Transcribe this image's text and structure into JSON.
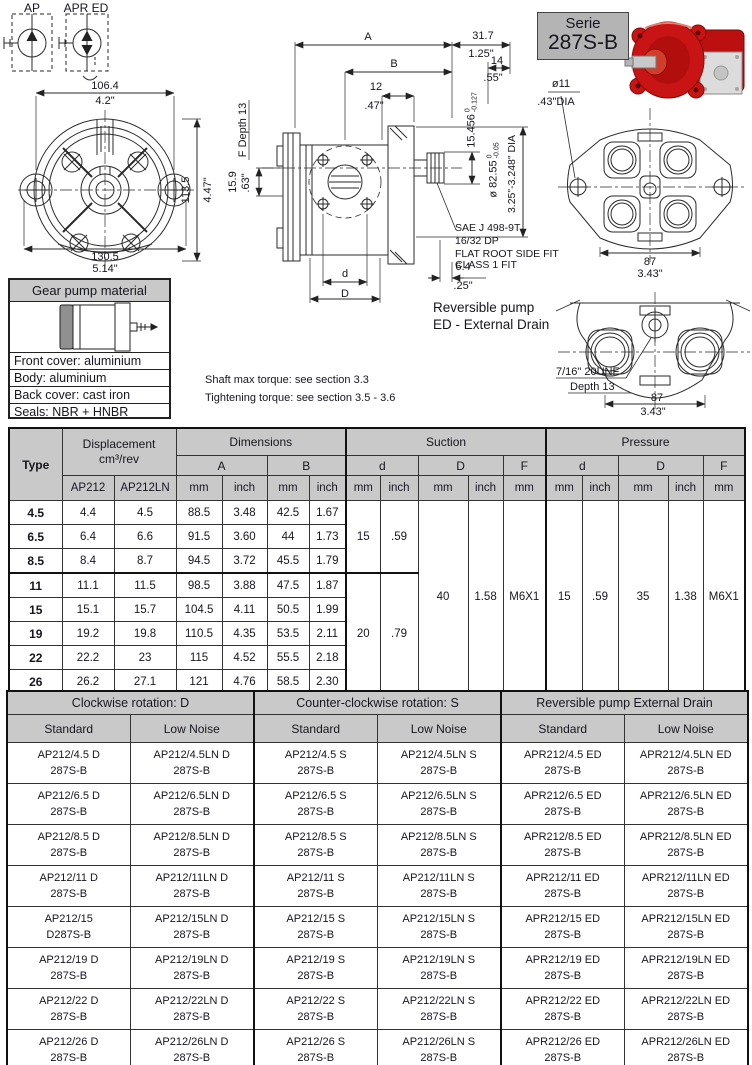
{
  "symbols": {
    "ap": "AP",
    "apr_ed": "APR ED"
  },
  "serie_box": {
    "line1": "Serie",
    "line2": "287S-B"
  },
  "front_view": {
    "width_mm": "106.4",
    "width_in": "4.2\"",
    "height_mm": "113.5",
    "height_in": "4.47\"",
    "total_width_mm": "130.5",
    "total_width_in": "5.14\""
  },
  "side_view": {
    "dim_a": "A",
    "dim_b": "B",
    "d31_7": "31.7",
    "d1_25": "1.25\"",
    "d14": "14",
    "d0_55": ".55\"",
    "d12": "12",
    "d0_47": ".47\"",
    "f_depth": "F Depth 13",
    "d15_9": "15.9",
    "d0_63": ".63\"",
    "shaft_tol": {
      "value": "15.456",
      "top": "0",
      "bottom": "-0.127"
    },
    "pilot_tol": {
      "value": "ø 82.55",
      "top": "0",
      "bottom": "-0.05"
    },
    "pilot_dia_in": "3.25\"-3.248\" DIA",
    "spline_note": [
      "SAE J 498-9T",
      "16/32 DP",
      "FLAT ROOT SIDE FIT",
      "CLASS 1 FIT"
    ],
    "dim_d": "d",
    "dim_D": "D",
    "d6_4": "6.4",
    "d0_25": ".25\""
  },
  "rear_view": {
    "dia11": "ø11",
    "dia11_in": ".43\"DIA",
    "width_mm": "87",
    "width_in": "3.43\""
  },
  "reversible_view": {
    "label_l1": "Reversible pump",
    "label_l2": "ED - External Drain",
    "port": "7/16\" 20UNF",
    "port_depth": "Depth 13",
    "width_mm": "87",
    "width_in": "3.43\""
  },
  "material_box": {
    "title": "Gear pump material",
    "rows": [
      "Front cover: aluminium",
      "Body: aluminium",
      "Back cover: cast iron",
      "Seals: NBR + HNBR"
    ]
  },
  "notes": [
    "Shaft max torque: see section 3.3",
    "Tightening torque: see section 3.5 - 3.6"
  ],
  "dim_table": {
    "headers": {
      "type": "Type",
      "displacement_l1": "Displacement",
      "displacement_l2": "cm³/rev",
      "dimensions": "Dimensions",
      "suction": "Suction",
      "pressure": "Pressure",
      "col_a": "A",
      "col_b": "B",
      "col_d": "d",
      "col_dd": "D",
      "col_f": "F",
      "mm": "mm",
      "inch": "inch",
      "ap212": "AP212",
      "ap212ln": "AP212LN"
    },
    "rows": [
      {
        "type": "4.5",
        "ap212": "4.4",
        "ap212ln": "4.5",
        "a_mm": "88.5",
        "a_inch": "3.48",
        "b_mm": "42.5",
        "b_inch": "1.67"
      },
      {
        "type": "6.5",
        "ap212": "6.4",
        "ap212ln": "6.6",
        "a_mm": "91.5",
        "a_inch": "3.60",
        "b_mm": "44",
        "b_inch": "1.73"
      },
      {
        "type": "8.5",
        "ap212": "8.4",
        "ap212ln": "8.7",
        "a_mm": "94.5",
        "a_inch": "3.72",
        "b_mm": "45.5",
        "b_inch": "1.79"
      },
      {
        "type": "11",
        "ap212": "11.1",
        "ap212ln": "11.5",
        "a_mm": "98.5",
        "a_inch": "3.88",
        "b_mm": "47.5",
        "b_inch": "1.87"
      },
      {
        "type": "15",
        "ap212": "15.1",
        "ap212ln": "15.7",
        "a_mm": "104.5",
        "a_inch": "4.11",
        "b_mm": "50.5",
        "b_inch": "1.99"
      },
      {
        "type": "19",
        "ap212": "19.2",
        "ap212ln": "19.8",
        "a_mm": "110.5",
        "a_inch": "4.35",
        "b_mm": "53.5",
        "b_inch": "2.11"
      },
      {
        "type": "22",
        "ap212": "22.2",
        "ap212ln": "23",
        "a_mm": "115",
        "a_inch": "4.52",
        "b_mm": "55.5",
        "b_inch": "2.18"
      },
      {
        "type": "26",
        "ap212": "26.2",
        "ap212ln": "27.1",
        "a_mm": "121",
        "a_inch": "4.76",
        "b_mm": "58.5",
        "b_inch": "2.30"
      }
    ],
    "suction": {
      "d_groups": [
        {
          "span": 3,
          "mm": "15",
          "inch": ".59"
        },
        {
          "span": 5,
          "mm": "20",
          "inch": ".79"
        }
      ],
      "D_mm": "40",
      "D_inch": "1.58",
      "F": "M6X1"
    },
    "pressure": {
      "d_mm": "15",
      "d_inch": ".59",
      "D_mm": "35",
      "D_inch": "1.38",
      "F": "M6X1"
    }
  },
  "order_table": {
    "groups": [
      {
        "title": "Clockwise rotation: D",
        "subs": [
          "Standard",
          "Low Noise"
        ]
      },
      {
        "title": "Counter-clockwise rotation: S",
        "subs": [
          "Standard",
          "Low Noise"
        ]
      },
      {
        "title": "Reversible pump External Drain",
        "subs": [
          "Standard",
          "Low Noise"
        ]
      }
    ],
    "rows": [
      [
        "AP212/4.5 D\n287S-B",
        "AP212/4.5LN D\n287S-B",
        "AP212/4.5 S\n287S-B",
        "AP212/4.5LN S\n287S-B",
        "APR212/4.5 ED\n287S-B",
        "APR212/4.5LN ED\n287S-B"
      ],
      [
        "AP212/6.5 D\n287S-B",
        "AP212/6.5LN D\n287S-B",
        "AP212/6.5 S\n287S-B",
        "AP212/6.5LN S\n287S-B",
        "APR212/6.5 ED\n287S-B",
        "APR212/6.5LN ED\n287S-B"
      ],
      [
        "AP212/8.5 D\n287S-B",
        "AP212/8.5LN D\n287S-B",
        "AP212/8.5 S\n287S-B",
        "AP212/8.5LN S\n287S-B",
        "APR212/8.5 ED\n287S-B",
        "APR212/8.5LN ED\n287S-B"
      ],
      [
        "AP212/11 D\n287S-B",
        "AP212/11LN D\n287S-B",
        "AP212/11 S\n287S-B",
        "AP212/11LN S\n287S-B",
        "APR212/11 ED\n287S-B",
        "APR212/11LN ED\n287S-B"
      ],
      [
        "AP212/15\nD287S-B",
        "AP212/15LN D\n287S-B",
        "AP212/15 S\n287S-B",
        "AP212/15LN S\n287S-B",
        "APR212/15 ED\n287S-B",
        "APR212/15LN ED\n287S-B"
      ],
      [
        "AP212/19 D\n287S-B",
        "AP212/19LN D\n287S-B",
        "AP212/19 S\n287S-B",
        "AP212/19LN S\n287S-B",
        "APR212/19 ED\n287S-B",
        "APR212/19LN ED\n287S-B"
      ],
      [
        "AP212/22 D\n287S-B",
        "AP212/22LN D\n287S-B",
        "AP212/22 S\n287S-B",
        "AP212/22LN S\n287S-B",
        "APR212/22 ED\n287S-B",
        "APR212/22LN ED\n287S-B"
      ],
      [
        "AP212/26 D\n287S-B",
        "AP212/26LN D\n287S-B",
        "AP212/26 S\n287S-B",
        "AP212/26LN S\n287S-B",
        "APR212/26 ED\n287S-B",
        "APR212/26LN ED\n287S-B"
      ]
    ]
  }
}
